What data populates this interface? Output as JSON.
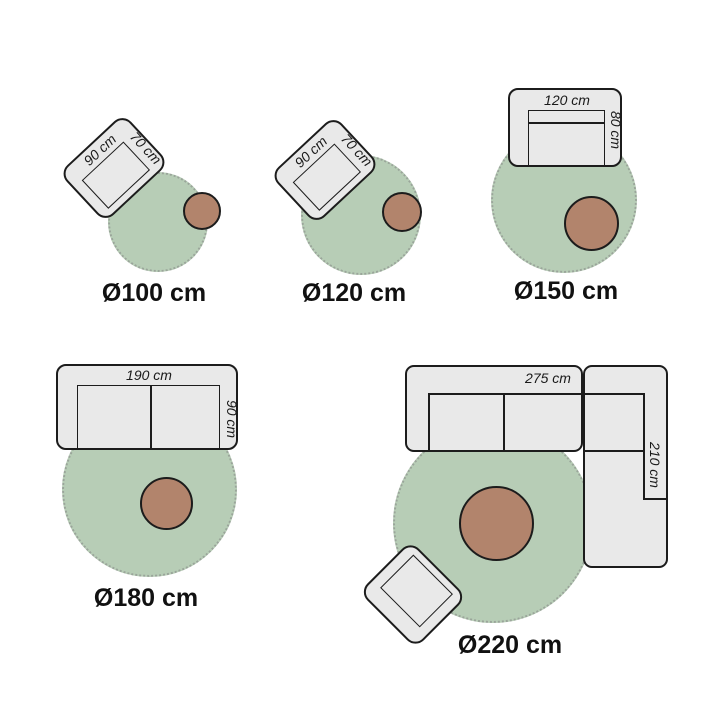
{
  "title": "rug size guide",
  "colors": {
    "rug_fill": "#b7cdb6",
    "rug_edge": "#9aa59a",
    "table_fill": "#b2846c",
    "furniture_fill": "#e9e9e9",
    "outline": "#1c1c1c",
    "label_color": "#111111"
  },
  "groups": [
    {
      "id": "rug-100",
      "rug_diameter_label": "Ø100 cm",
      "furniture": {
        "type": "armchair",
        "width_label": "90 cm",
        "depth_label": "70 cm"
      },
      "accessory": "side-table"
    },
    {
      "id": "rug-120",
      "rug_diameter_label": "Ø120 cm",
      "furniture": {
        "type": "armchair",
        "width_label": "90 cm",
        "depth_label": "70 cm"
      },
      "accessory": "side-table"
    },
    {
      "id": "rug-150",
      "rug_diameter_label": "Ø150 cm",
      "furniture": {
        "type": "sofa",
        "width_label": "120 cm",
        "depth_label": "80 cm"
      },
      "accessory": "side-table"
    },
    {
      "id": "rug-180",
      "rug_diameter_label": "Ø180 cm",
      "furniture": {
        "type": "sofa",
        "width_label": "190 cm",
        "depth_label": "90 cm"
      },
      "accessory": "side-table"
    },
    {
      "id": "rug-220",
      "rug_diameter_label": "Ø220 cm",
      "furniture": {
        "type": "corner-sofa",
        "width_label": "275 cm",
        "depth_label": "210 cm"
      },
      "extra_furniture": {
        "type": "armchair"
      },
      "accessory": "side-table"
    }
  ]
}
